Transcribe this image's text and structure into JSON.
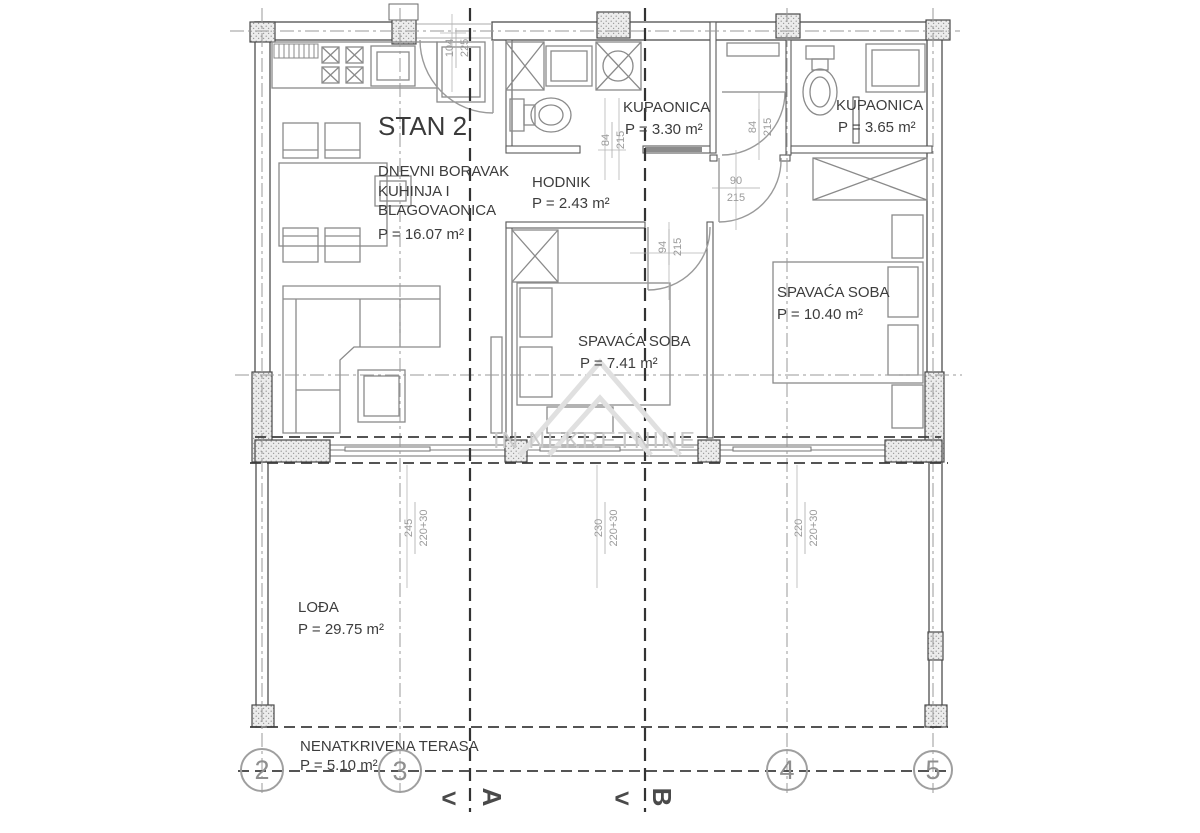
{
  "title": "STAN 2",
  "watermark": "IN NEKRETNINE",
  "rooms": {
    "living": {
      "name_line1": "DNEVNI BORAVAK",
      "name_line2": "KUHINJA I",
      "name_line3": "BLAGOVAONICA",
      "area": "P = 16.07 m²"
    },
    "hallway": {
      "name": "HODNIK",
      "area": "P = 2.43 m²"
    },
    "bathroom1": {
      "name": "KUPAONICA",
      "area": "P = 3.30 m²"
    },
    "bathroom2": {
      "name": "KUPAONICA",
      "area": "P = 3.65 m²"
    },
    "bedroom1": {
      "name": "SPAVAĆA SOBA",
      "area": "P = 7.41 m²"
    },
    "bedroom2": {
      "name": "SPAVAĆA SOBA",
      "area": "P = 10.40 m²"
    },
    "loggia": {
      "name": "LOĐA",
      "area": "P = 29.75 m²"
    },
    "terrace": {
      "name": "NENATKRIVENA TERASA",
      "area": "P = 5.10 m²"
    }
  },
  "dimensions": {
    "entrance_door": {
      "width": "104",
      "height": "225"
    },
    "bathroom1_door": {
      "width": "84",
      "height": "215"
    },
    "bathroom2_door": {
      "width": "84",
      "height": "215"
    },
    "hall_door": {
      "width": "90",
      "height": "215"
    },
    "bedroom1_door": {
      "width": "94",
      "height": "215"
    },
    "window_left": {
      "width": "245",
      "height": "220+30"
    },
    "window_middle": {
      "width": "230",
      "height": "220+30"
    },
    "window_right": {
      "width": "220",
      "height": "220+30"
    }
  },
  "grid_axes": {
    "b2": "2",
    "b3": "3",
    "b4": "4",
    "b5": "5"
  },
  "section_markers": {
    "a": "A",
    "b": "B",
    "arrow": "<"
  }
}
